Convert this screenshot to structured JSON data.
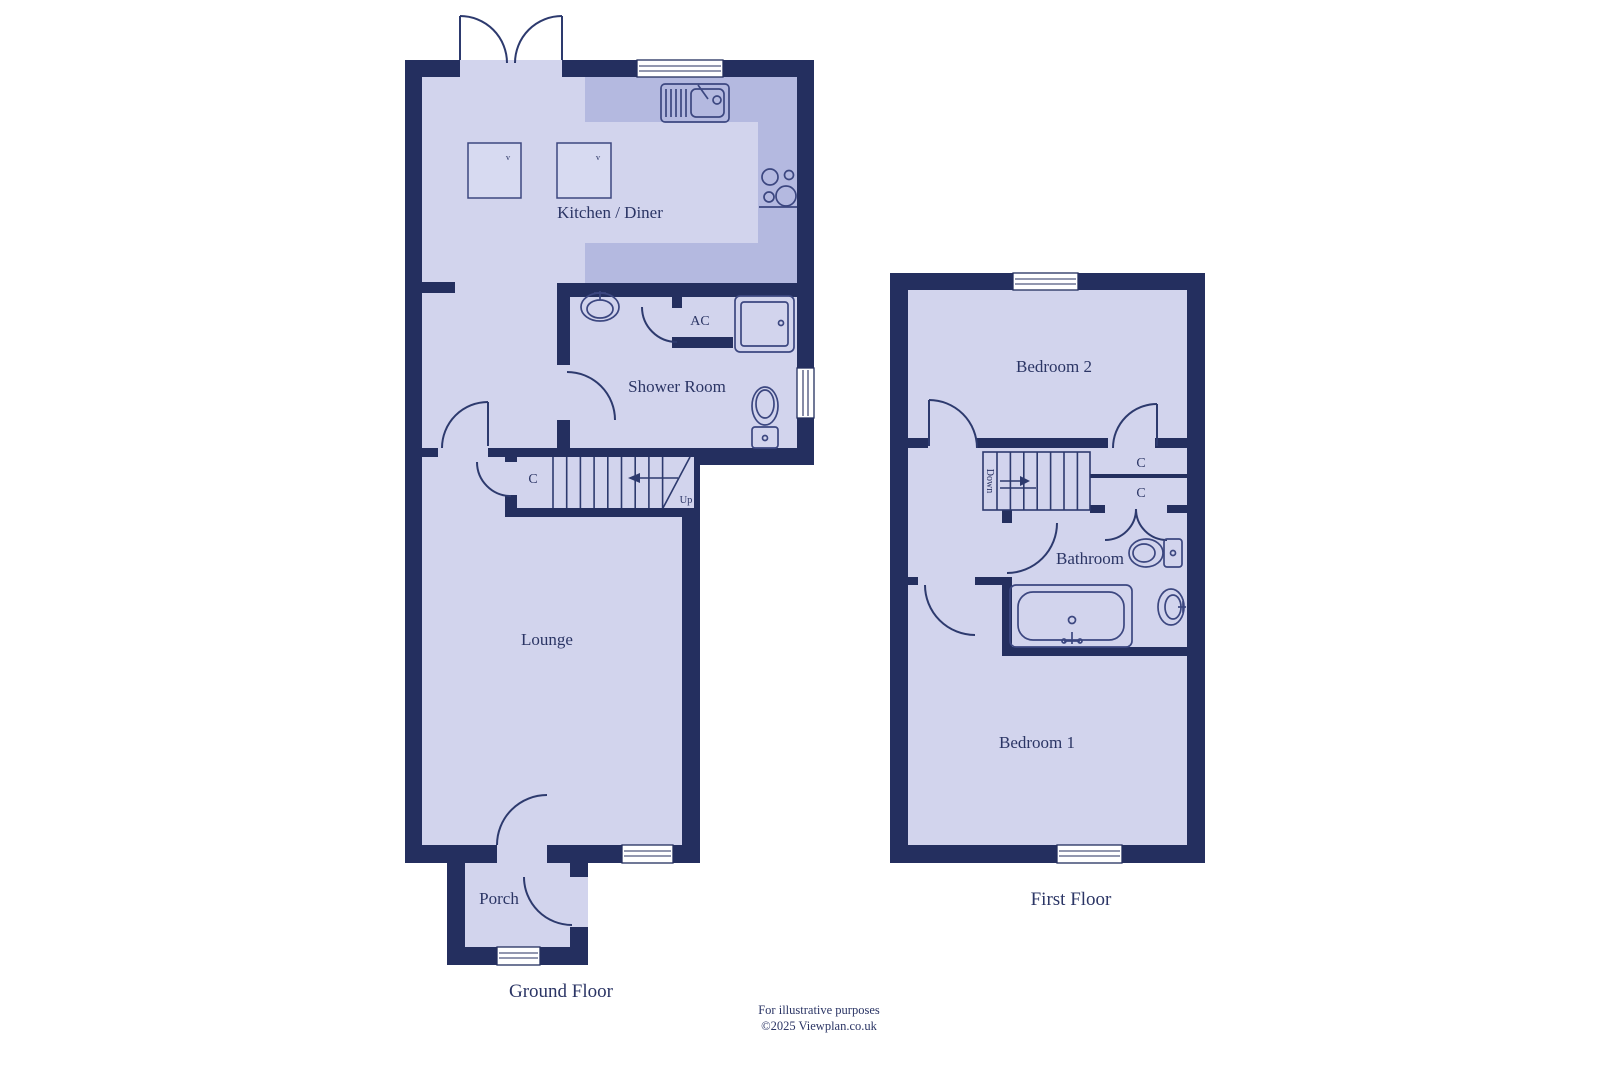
{
  "ground": {
    "title": "Ground Floor",
    "rooms": {
      "kitchen": "Kitchen / Diner",
      "shower_room": "Shower Room",
      "lounge": "Lounge",
      "porch": "Porch"
    },
    "labels": {
      "ac": "AC",
      "cupboard": "C",
      "up": "Up",
      "appliance_mark_1": "v",
      "appliance_mark_2": "v"
    }
  },
  "first": {
    "title": "First Floor",
    "rooms": {
      "bedroom2": "Bedroom 2",
      "bedroom1": "Bedroom 1",
      "bathroom": "Bathroom"
    },
    "labels": {
      "cupboard_top": "C",
      "cupboard_bottom": "C",
      "down": "Down"
    }
  },
  "footer": {
    "line1": "For illustrative purposes",
    "line2": "©2025 Viewplan.co.uk"
  },
  "colors": {
    "wall": "#242f5f",
    "floor": "#d2d4ed",
    "counter": "#b4b9e0",
    "line": "#2d3a6e",
    "fixture": "#3c4780",
    "text": "#2b3565",
    "background": "#ffffff"
  }
}
